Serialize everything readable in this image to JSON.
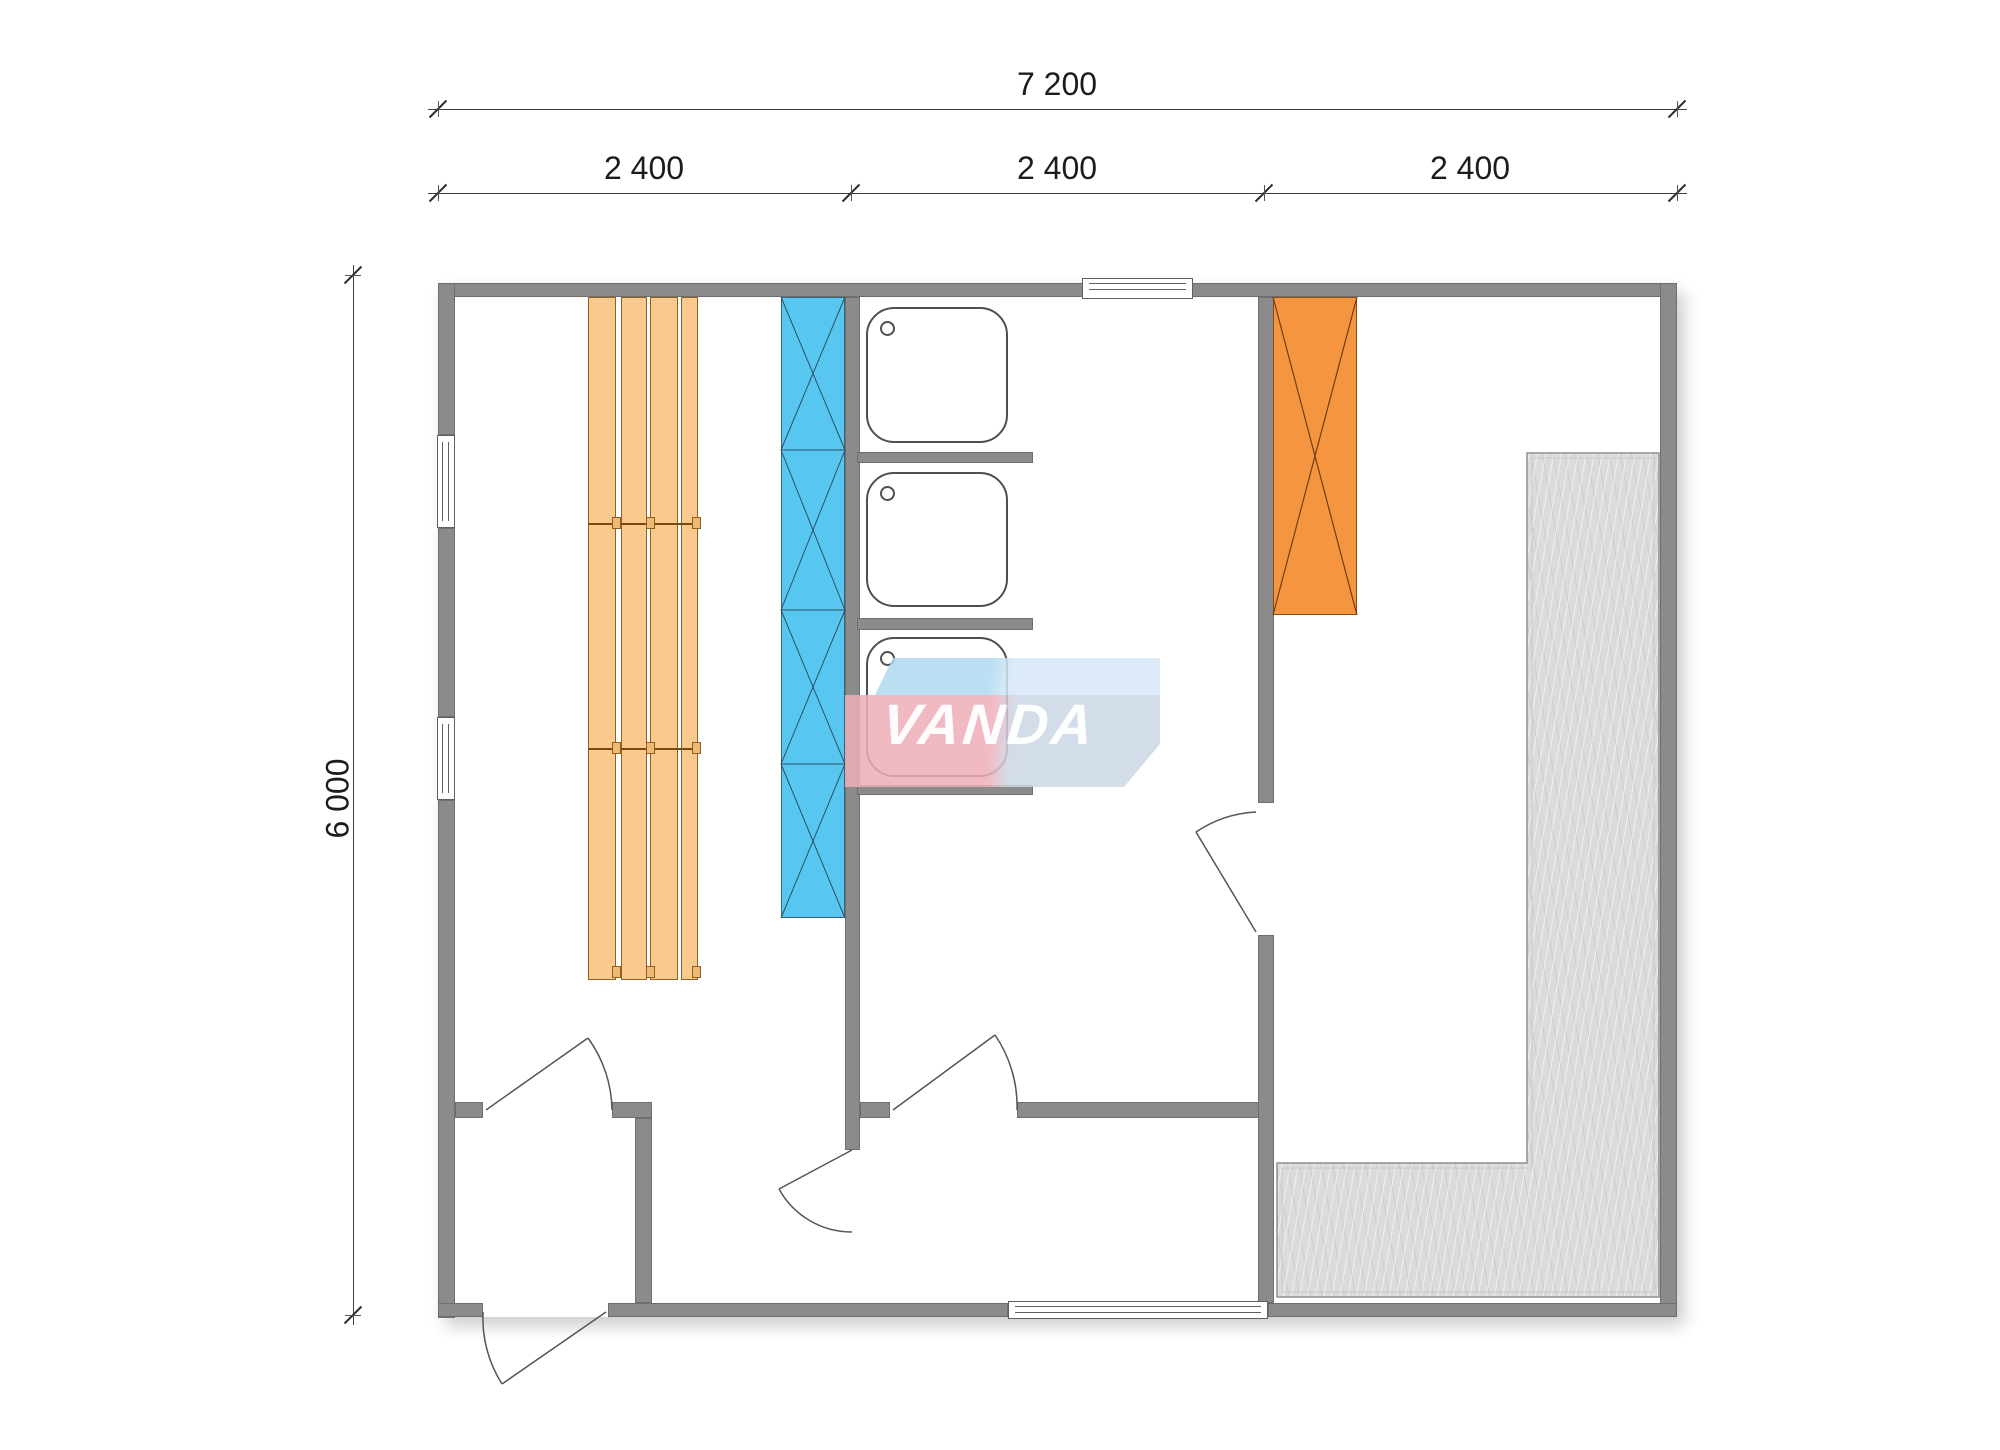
{
  "dimensions": {
    "total_width_label": "7 200",
    "segment_labels": [
      "2 400",
      "2 400",
      "2 400"
    ],
    "height_label": "6 000"
  },
  "watermark": {
    "text": "VANDA"
  },
  "colors": {
    "wall": "#8B8B8B",
    "wall_outline": "#6E6E6E",
    "bench_fill": "#F9C98E",
    "bench_border": "#93601F",
    "panel_blue": "#57C7F1",
    "stove_orange": "#F6953F",
    "deck_gray": "#DBDBDB",
    "dim_text": "#1C1C1C",
    "logo_pink": "#EFAFB9",
    "logo_blue_left": "#AED9F0",
    "logo_blue_right": "#D7E8F6",
    "logo_gray_blue": "#CCD8E6"
  }
}
